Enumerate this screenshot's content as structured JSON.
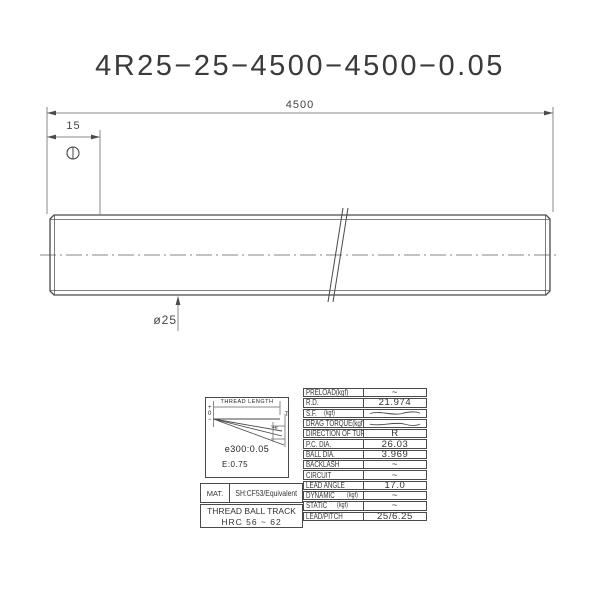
{
  "title": "4R25−25−4500−4500−0.05",
  "dimensions": {
    "overall_length": "4500",
    "end_offset": "15",
    "shaft_diameter": "ø25"
  },
  "lead_detail": {
    "header": "THREAD LENGTH",
    "axis_plus": "+",
    "axis_zero": "0",
    "axis_minus": "−",
    "t_label": "T",
    "e_label": "+e",
    "tolerance": "e300:0.05",
    "variation": "E:0.75"
  },
  "material": {
    "label": "MAT.",
    "value": "SH:CF53/Equivalent",
    "hardness_line1": "THREAD BALL TRACK",
    "hardness_line2": "HRC 56 ~ 62"
  },
  "spec_table": {
    "rows": [
      {
        "label": "PRELOAD(kgf)",
        "unit": "",
        "value": "~"
      },
      {
        "label": "R.D.",
        "unit": "",
        "value": "21.974"
      },
      {
        "label": "S.F.",
        "unit": "(kgf)",
        "value": ""
      },
      {
        "label": "DRAG TORQUE(kgf-cm)",
        "unit": "",
        "value": ""
      },
      {
        "label": "DIRECTION OF TURN",
        "unit": "",
        "value": "R"
      },
      {
        "label": "P.C. DIA.",
        "unit": "",
        "value": "26.03"
      },
      {
        "label": "BALL DIA.",
        "unit": "",
        "value": "3.969"
      },
      {
        "label": "BACKLASH",
        "unit": "",
        "value": "~"
      },
      {
        "label": "CIRCUIT",
        "unit": "",
        "value": "~"
      },
      {
        "label": "LEAD ANGLE",
        "unit": "",
        "value": "17.0"
      },
      {
        "label": "DYNAMIC",
        "unit": "(kgf)",
        "value": "~"
      },
      {
        "label": "STATIC",
        "unit": "(kgf)",
        "value": "~"
      },
      {
        "label": "LEAD/PITCH",
        "unit": "",
        "value": "25/6.25"
      }
    ]
  },
  "colors": {
    "line": "#4a4a4a",
    "centerline": "#b9b9b9",
    "text": "#333333",
    "background": "#ffffff"
  }
}
